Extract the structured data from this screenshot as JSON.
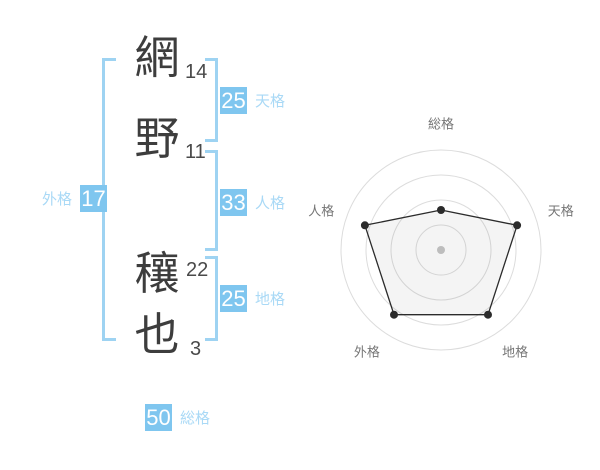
{
  "name": {
    "characters": [
      {
        "char": "網",
        "strokes": "14"
      },
      {
        "char": "野",
        "strokes": "11"
      },
      {
        "char": "穰",
        "strokes": "22"
      },
      {
        "char": "也",
        "strokes": "3"
      }
    ]
  },
  "kaku": {
    "tengaku": {
      "label": "天格",
      "value": "25"
    },
    "jinkaku": {
      "label": "人格",
      "value": "33"
    },
    "chikaku": {
      "label": "地格",
      "value": "25"
    },
    "gaikaku": {
      "label": "外格",
      "value": "17"
    },
    "soukaku": {
      "label": "総格",
      "value": "50"
    }
  },
  "chart_data": {
    "type": "radar",
    "axes": [
      "総格",
      "天格",
      "地格",
      "外格",
      "人格"
    ],
    "axis_values": [
      50,
      25,
      25,
      17,
      33
    ],
    "plotted_fraction": [
      0.4,
      0.8,
      0.8,
      0.8,
      0.8
    ],
    "rings": [
      0.25,
      0.5,
      0.75,
      1.0
    ],
    "start_angle_deg": -90,
    "direction": "clockwise",
    "grid": "concentric-circles",
    "legend": "none",
    "title": ""
  },
  "colors": {
    "badge_bg": "#7fc6ef",
    "badge_text": "#ffffff",
    "bracket": "#9ed3f2",
    "kaku_label": "#a9d9f6",
    "kanji": "#3d3d3d",
    "stroke_number": "#4a4a4a",
    "radar_ring": "#dcdcdc",
    "radar_line": "#2b2b2b",
    "radar_fill": "rgba(110,110,110,0.08)",
    "radar_center_dot": "#bdbdbd",
    "radar_label": "#757575",
    "background": "#ffffff"
  }
}
